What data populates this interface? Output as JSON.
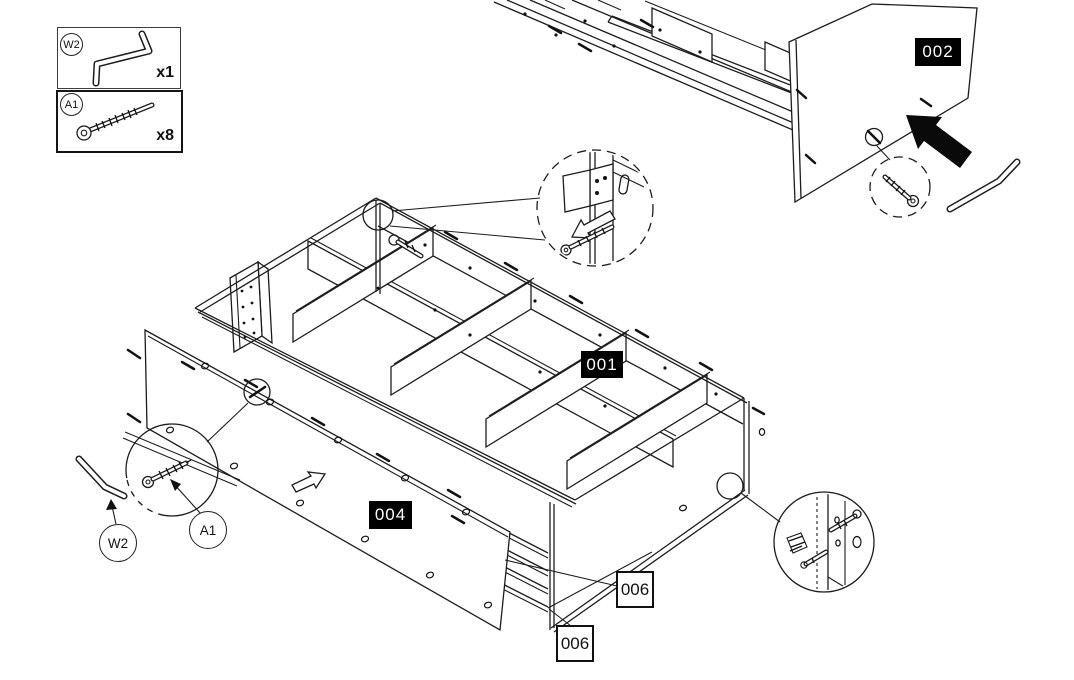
{
  "page": {
    "background": "#ffffff",
    "line_color": "#1c1c1c",
    "label_bg": "#000000",
    "label_fg": "#ffffff"
  },
  "legend": {
    "items": [
      {
        "id": "W2",
        "tool": "allen-key",
        "qty": "x1"
      },
      {
        "id": "A1",
        "tool": "cam-screw",
        "qty": "x8"
      }
    ]
  },
  "part_labels": {
    "p002": "002",
    "p001": "001",
    "p004": "004",
    "p006_right": "006",
    "p006_bottom": "006"
  },
  "hardware_callouts": {
    "w2": "W2",
    "a1": "A1"
  }
}
